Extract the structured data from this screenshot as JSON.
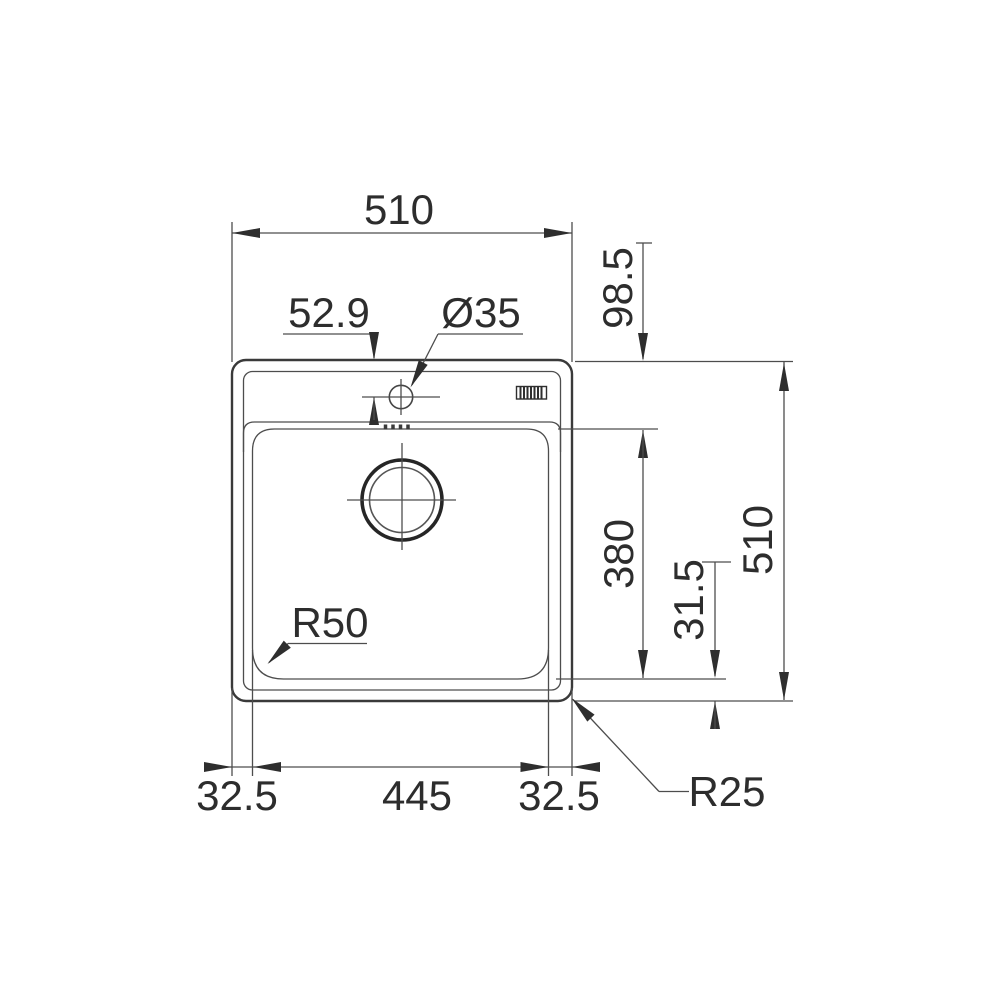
{
  "drawing": {
    "type": "technical-dimension-drawing",
    "subject": "inset kitchen sink with single bowl, top view",
    "background": "#ffffff",
    "line_color": "#4d4d4d",
    "text_color": "#2d2d2d",
    "labels": {
      "top_width": "510",
      "hole_offset": "52.9",
      "hole_diameter": "Ø35",
      "rim_depth": "98.5",
      "bowl_length": "380",
      "bowl_bottom_offset": "31.5",
      "overall_depth": "510",
      "bottom_left_offset": "32.5",
      "bowl_width": "445",
      "bottom_right_offset": "32.5",
      "bowl_corner_radius": "R50",
      "outer_corner_radius": "R25"
    }
  }
}
